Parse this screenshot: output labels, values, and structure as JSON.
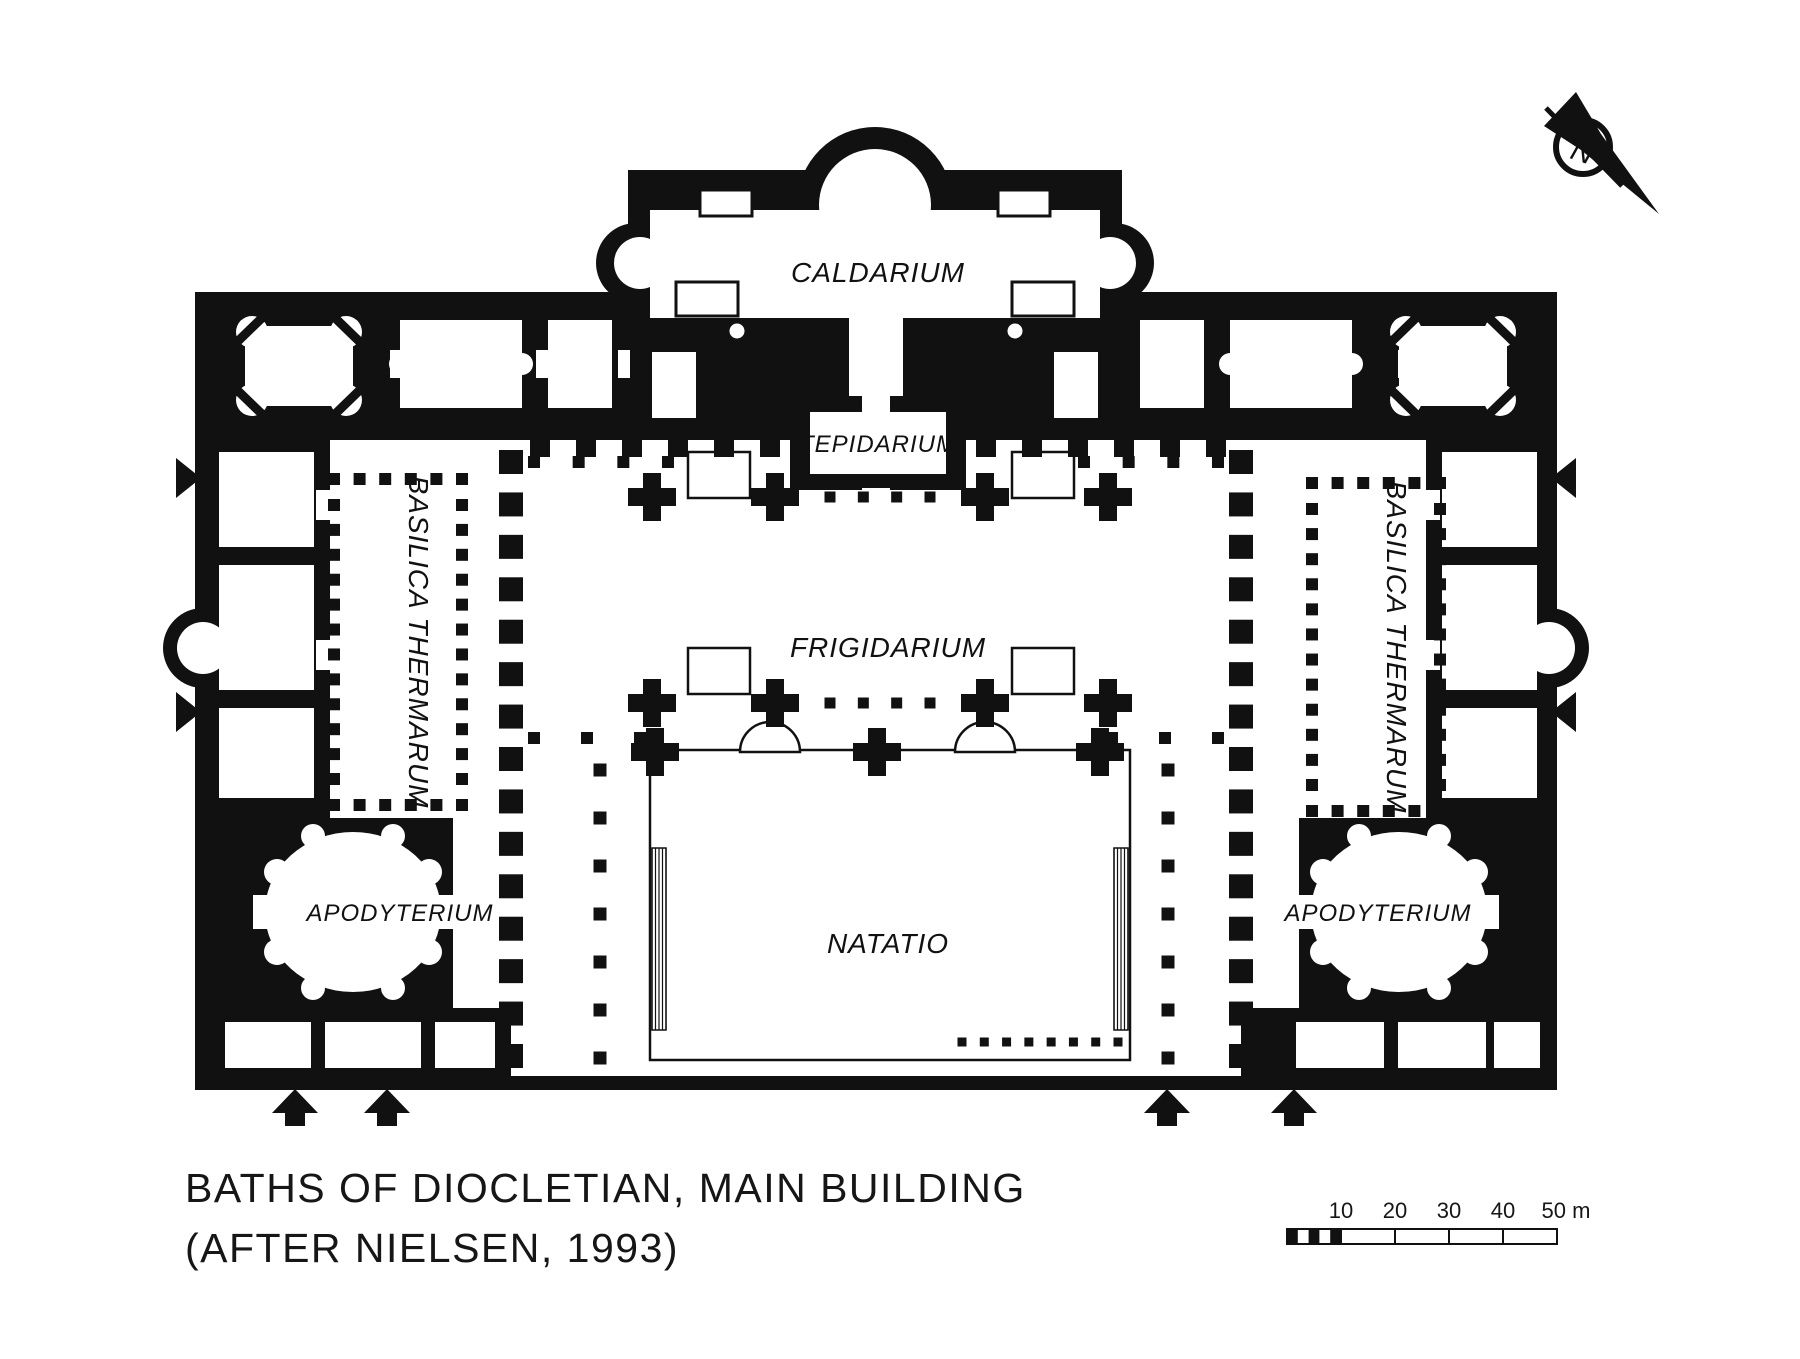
{
  "page": {
    "background": "#ffffff",
    "ink": "#111111"
  },
  "labels": {
    "caldarium": "CALDARIUM",
    "tepidarium": "TEPIDARIUM",
    "frigidarium": "FRIGIDARIUM",
    "natatio": "NATATIO",
    "basilica_left": "BASILICA THERMARUM",
    "basilica_right": "BASILICA THERMARUM",
    "apodyterium_left": "APODYTERIUM",
    "apodyterium_right": "APODYTERIUM",
    "watermark_1": "BASILICA THERMARUM",
    "watermark_2": "BASILICA THERMARUM"
  },
  "title": {
    "line1": "BATHS OF DIOCLETIAN, MAIN BUILDING",
    "line2": "(AFTER NIELSEN, 1993)"
  },
  "scalebar": {
    "tick_10": "10",
    "tick_20": "20",
    "tick_30": "30",
    "tick_40": "40",
    "end": "50 m"
  },
  "compass": {
    "north": "N"
  }
}
